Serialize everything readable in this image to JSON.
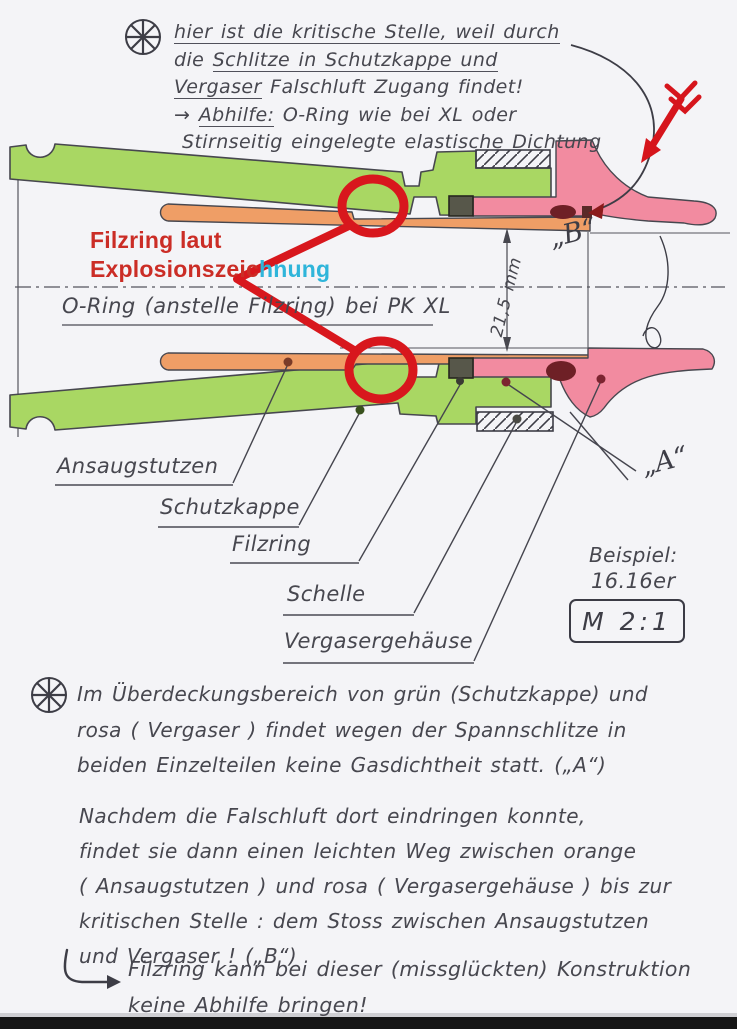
{
  "colors": {
    "paper": "#f4f4f7",
    "pencil": "#47474f",
    "schutzkappe_green": "#a9d763",
    "ansaugstutzen_orange": "#ef9e66",
    "vergaser_pink": "#f28ba0",
    "filzring_dark": "#57574a",
    "annotation_red": "#d8171d",
    "overlay_text_red": "#cb2d26",
    "overlay_text_cyan": "#2fb5da",
    "leak_maroon": "#6e2026"
  },
  "top_note": {
    "line1": "hier ist die kritische Stelle, weil durch",
    "line2_pre": "die ",
    "line2_u": "Schlitze in Schutzkappe und",
    "line3_u": "Vergaser",
    "line3_rest": " Falschluft Zugang findet!",
    "line4_pre": "→ ",
    "line4_u": "Abhilfe:",
    "line4_rest": " O-Ring wie bei XL oder",
    "line5": "Stirnseitig eingelegte elastische Dichtung"
  },
  "overlay_note": {
    "line1": "Filzring laut",
    "line2_red": "Explosionszeic",
    "line2_cyan": "hnung"
  },
  "oring_note": "O-Ring (anstelle Filzring) bei PK XL",
  "dimension_label": "21,5 mm",
  "point_b": "„B“",
  "point_a": "„A“",
  "part_labels": {
    "ansaugstutzen": "Ansaugstutzen",
    "schutzkappe": "Schutzkappe",
    "filzring": "Filzring",
    "schelle": "Schelle",
    "vergasergehaeuse": "Vergasergehäuse"
  },
  "example": {
    "title": "Beispiel:",
    "value": "16.16er",
    "scale": "M 2:1"
  },
  "para1": {
    "l1": "Im Überdeckungsbereich von grün (Schutzkappe) und",
    "l2": "rosa ( Vergaser ) findet wegen der Spannschlitze in",
    "l3": "beiden Einzelteilen keine Gasdichtheit statt. („A“)"
  },
  "para2": {
    "l1": "Nachdem die Falschluft dort eindringen konnte,",
    "l2": "findet sie dann einen leichten Weg zwischen orange",
    "l3": "( Ansaugstutzen ) und rosa ( Vergasergehäuse ) bis zur",
    "l4": "kritischen Stelle : dem Stoss zwischen Ansaugstutzen",
    "l5": "und Vergaser ! („B“)"
  },
  "footnote": {
    "l1": "Filzring kann bei dieser (missglückten) Konstruktion",
    "l2": "keine Abhilfe bringen!"
  }
}
